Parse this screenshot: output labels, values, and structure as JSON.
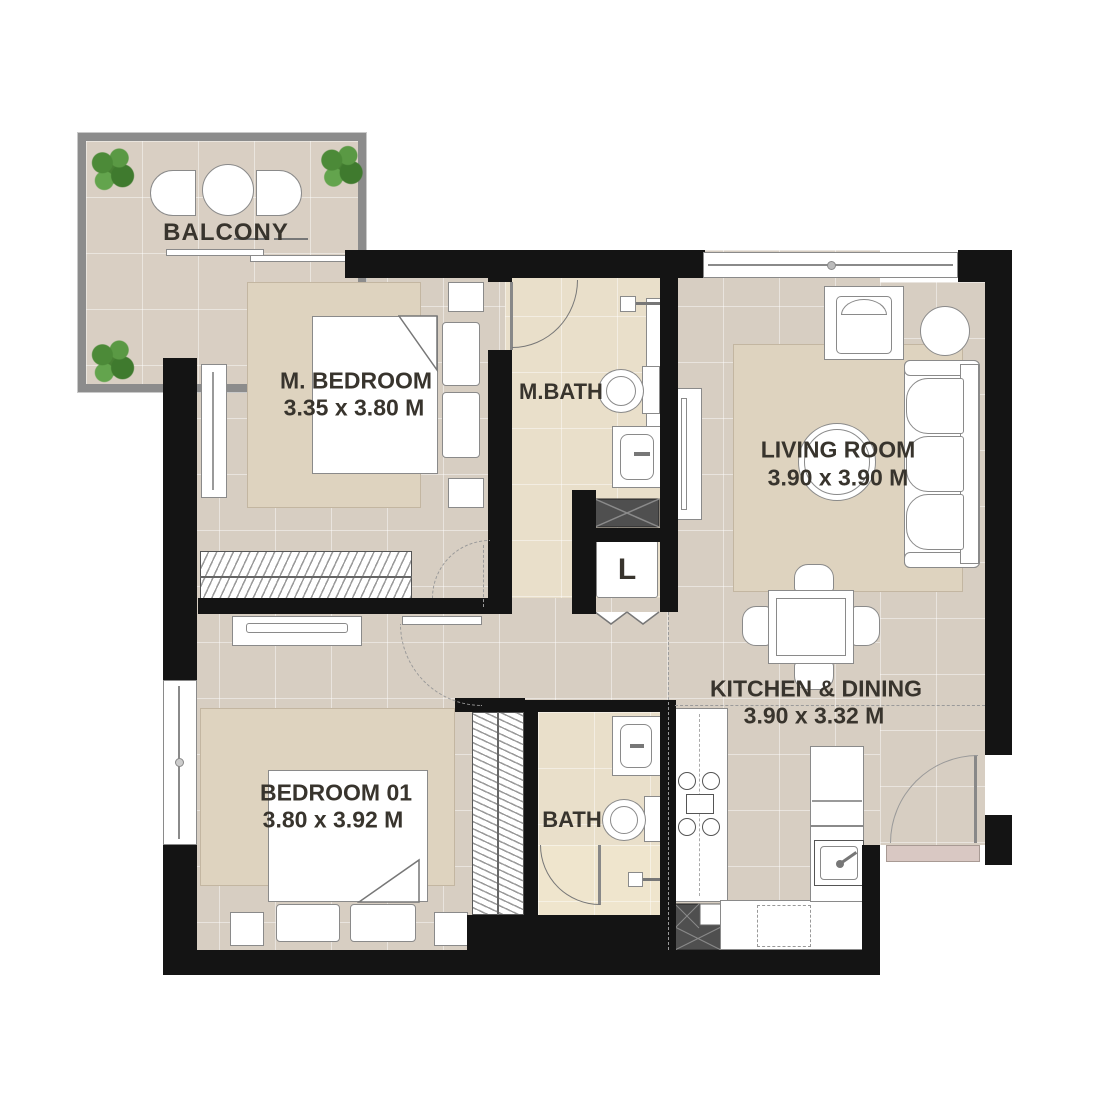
{
  "plan": {
    "type": "apartment-floor-plan",
    "rooms": [
      {
        "id": "balcony",
        "label": "BALCONY",
        "dimensions": ""
      },
      {
        "id": "m-bedroom",
        "label": "M. BEDROOM",
        "dimensions": "3.35 x 3.80 M"
      },
      {
        "id": "m-bath",
        "label": "M.BATH",
        "dimensions": ""
      },
      {
        "id": "living-room",
        "label": "LIVING ROOM",
        "dimensions": "3.90 x 3.90 M"
      },
      {
        "id": "kitchen-dining",
        "label": "KITCHEN & DINING",
        "dimensions": "3.90 x 3.32 M"
      },
      {
        "id": "bedroom-01",
        "label": "BEDROOM 01",
        "dimensions": "3.80 x 3.92 M"
      },
      {
        "id": "bath",
        "label": "BATH",
        "dimensions": ""
      },
      {
        "id": "laundry-closet",
        "label": "L",
        "dimensions": ""
      }
    ],
    "colors": {
      "wall": "#141414",
      "floor": "#d7cec2",
      "bath_floor": "#e9dfca",
      "rug": "#ded3bf",
      "fixture_outline": "#8a8a8a",
      "shower_tray": "#4f4f4f",
      "plant_green": "#4c8a38",
      "entry_step": "#d9c8c3",
      "background": "#ffffff",
      "text": "#38342d"
    },
    "fixtures": [
      "double-bed",
      "wardrobe",
      "dresser",
      "toilet",
      "wash-basin",
      "shower",
      "shower-tray",
      "washing-machine",
      "sofa-3-seat",
      "armchair",
      "round-side-table",
      "round-coffee-table",
      "tv-unit",
      "dining-table-4-chairs",
      "stove-4-burner",
      "kitchen-sink",
      "fridge",
      "balcony-chairs",
      "balcony-table",
      "planter",
      "entry-door",
      "sliding-door",
      "bifold-door"
    ]
  }
}
